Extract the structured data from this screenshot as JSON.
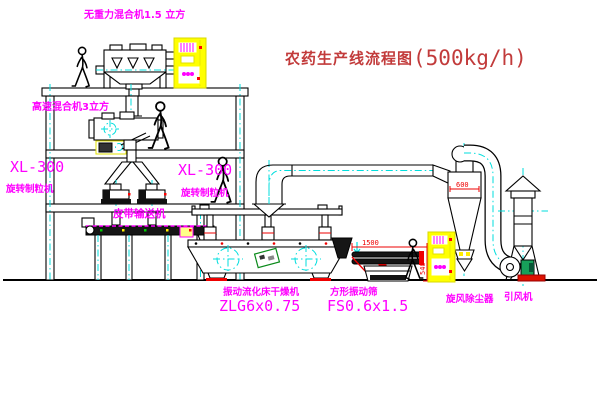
{
  "title": {
    "name": "农药生产线流程图",
    "capacity": "(500kg/h)"
  },
  "equipment": {
    "top_mixer": {
      "label": "无重力混合机1.5 立方"
    },
    "high_speed_mixer": {
      "label": "高速混合机3立方"
    },
    "granulator_left": {
      "model": "XL-300",
      "name": "旋转制粒机"
    },
    "granulator_right": {
      "model": "XL-300",
      "name": "旋转制粒机"
    },
    "belt_conveyor": {
      "label": "皮带输送机"
    },
    "dryer": {
      "name": "振动流化床干燥机",
      "model": "ZLG6x0.75"
    },
    "sieve": {
      "name": "方形振动筛",
      "model": "FS0.6x1.5"
    },
    "cyclone": {
      "label": "旋风除尘器"
    },
    "fan": {
      "label": "引风机"
    }
  },
  "dimensions": {
    "sieve_length": "1500",
    "sieve_height": "540",
    "cyclone_width": "600"
  },
  "colors": {
    "label_magenta": "#ff00ff",
    "title_red": "#c23b3b",
    "centerline_cyan": "#00dede",
    "cabinet_yellow": "#ffff00",
    "accent_red": "#ee0000",
    "motor_green": "#17a05a"
  }
}
